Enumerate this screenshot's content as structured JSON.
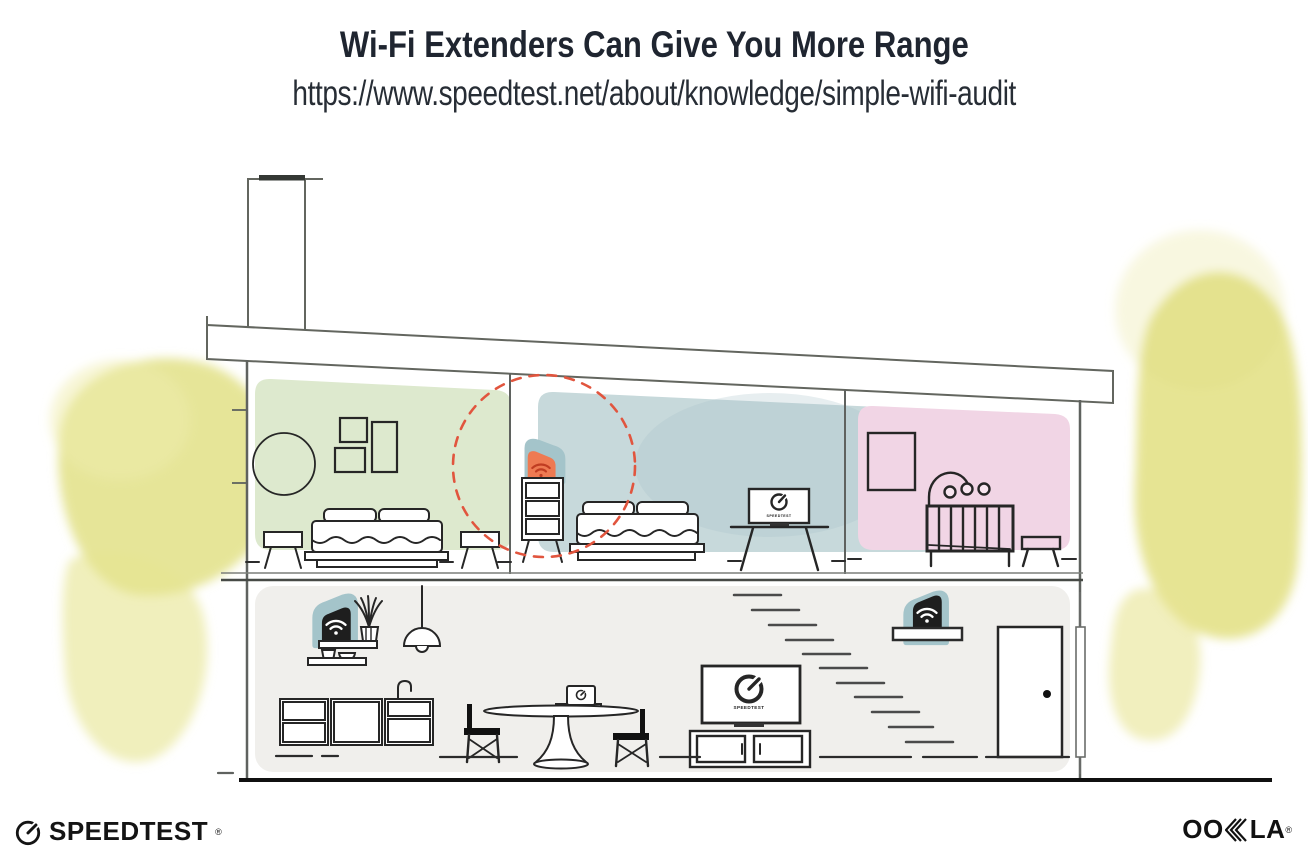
{
  "header": {
    "title": "Wi-Fi Extenders Can Give You More Range",
    "url": "https://www.speedtest.net/about/knowledge/simple-wifi-audit"
  },
  "screens": {
    "bedroom_tv_label": "SPEEDTEST",
    "living_tv_label": "SPEEDTEST"
  },
  "branding": {
    "speedtest_label": "SPEEDTEST",
    "speedtest_reg": "®",
    "ookla_oo": "OO",
    "ookla_la": "LA",
    "ookla_reg": "®"
  },
  "icons": {
    "speedtest_gauge": "gauge-icon",
    "router_wifi": "wifi-icon",
    "extender_wifi": "wifi-icon",
    "extender_range": "dashed-range-circle"
  },
  "colors": {
    "ink": "#1f2530",
    "structure_line": "#5f625f",
    "furniture_line": "#262626",
    "room_green": "#dde9ce",
    "room_blue": "#c7d9db",
    "room_pink": "#f1d5e5",
    "floor_gray": "#f0efec",
    "device_teal": "#a4c4ca",
    "extender_orange": "#ee7a52",
    "extender_wifi_red": "#c03d22",
    "range_dash_red": "#e1553e",
    "foliage_yellow": "#e0de7e"
  }
}
